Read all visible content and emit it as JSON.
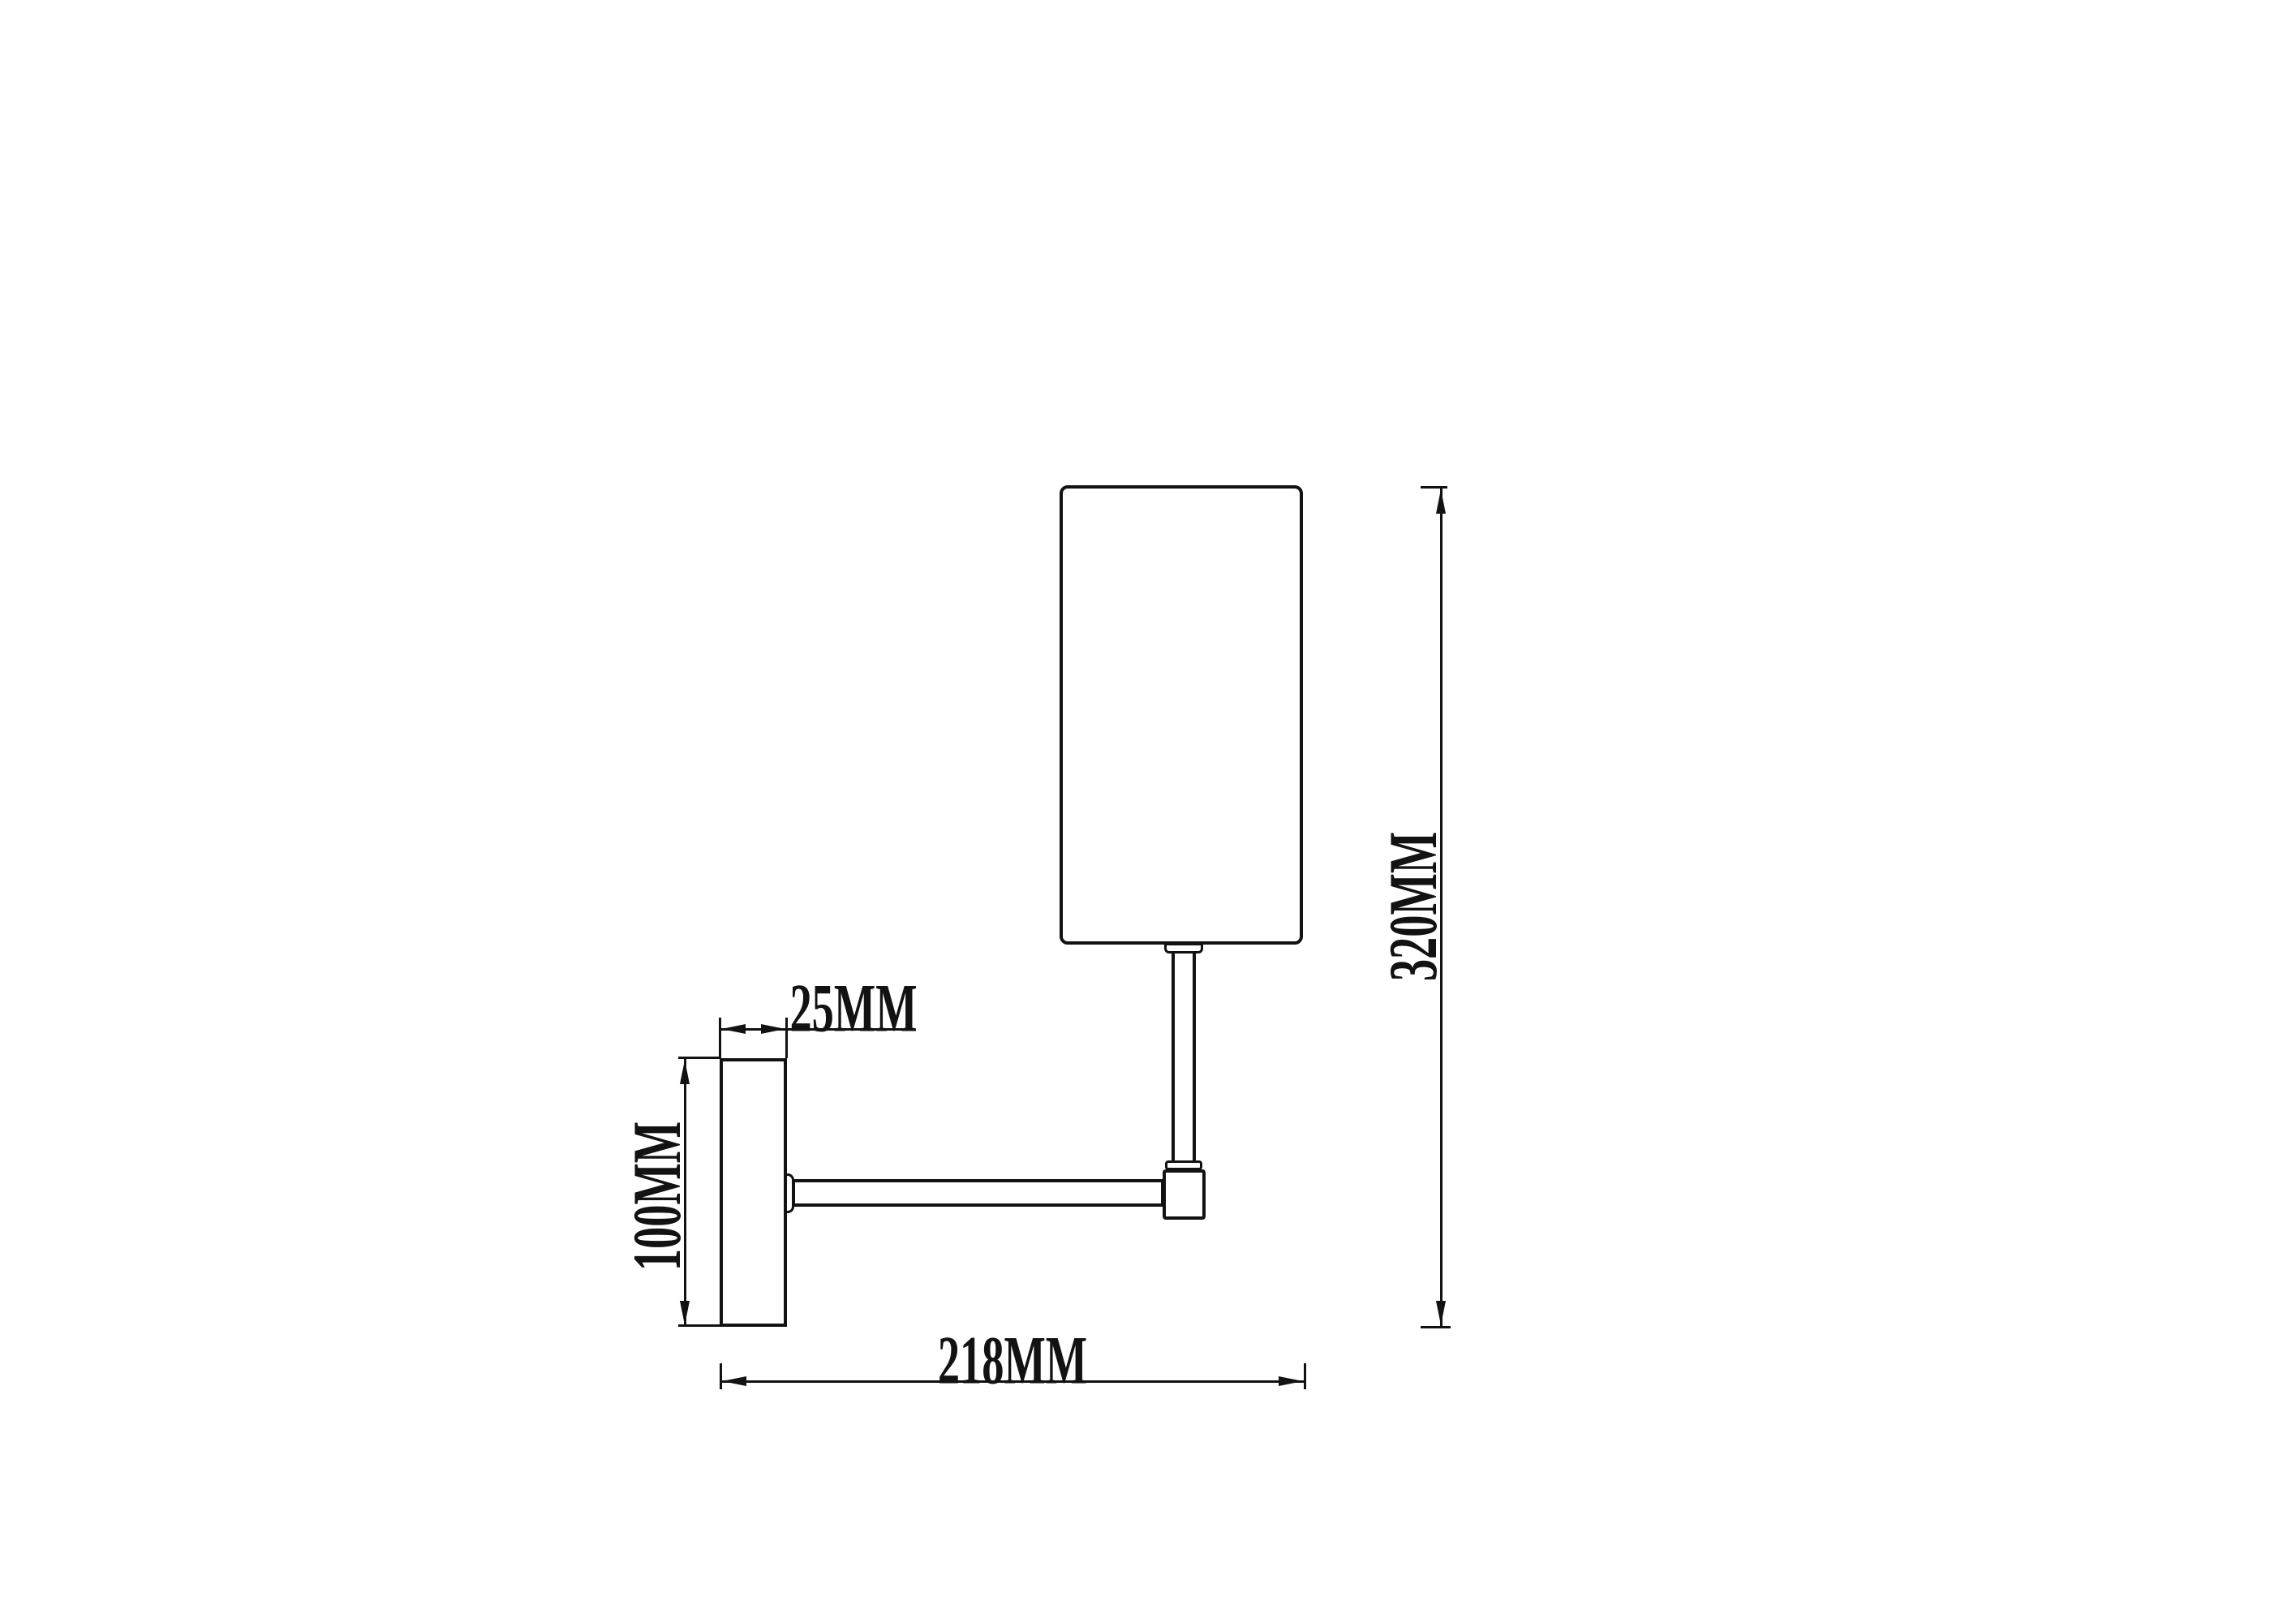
{
  "drawing": {
    "kind": "wall-lamp dimension drawing",
    "background": "#ffffff",
    "line_color": "#121212",
    "labels": {
      "plate_depth": "25MM",
      "plate_height": "100MM",
      "projection": "218MM",
      "total_height": "320MM"
    }
  }
}
